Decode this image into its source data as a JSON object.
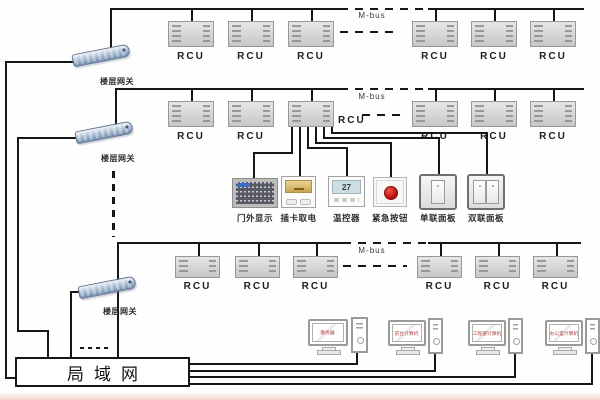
{
  "labels": {
    "rcu": "RCU",
    "m_bus": "M-bus",
    "floor_gateway": "楼层网关"
  },
  "lan": {
    "label": "局域网"
  },
  "room_devices": [
    {
      "label": "门外显示"
    },
    {
      "label": "插卡取电"
    },
    {
      "label": "温控器",
      "display_value": "27"
    },
    {
      "label": "紧急按钮"
    },
    {
      "label": "单联面板"
    },
    {
      "label": "双联面板"
    }
  ],
  "computers": [
    {
      "label": "服务器"
    },
    {
      "label": "前台计算机"
    },
    {
      "label": "工程部计算机"
    },
    {
      "label": "办公室计算机"
    }
  ],
  "colors": {
    "line": "#161616",
    "rcu_fill": "#d7d7d5",
    "gateway_blue": "#8aa3c0",
    "emergency_red": "#b50d0d",
    "card_gold": "#d4b25e",
    "lcd_blue": "#cddee4",
    "screen_text_red": "#b04040"
  }
}
